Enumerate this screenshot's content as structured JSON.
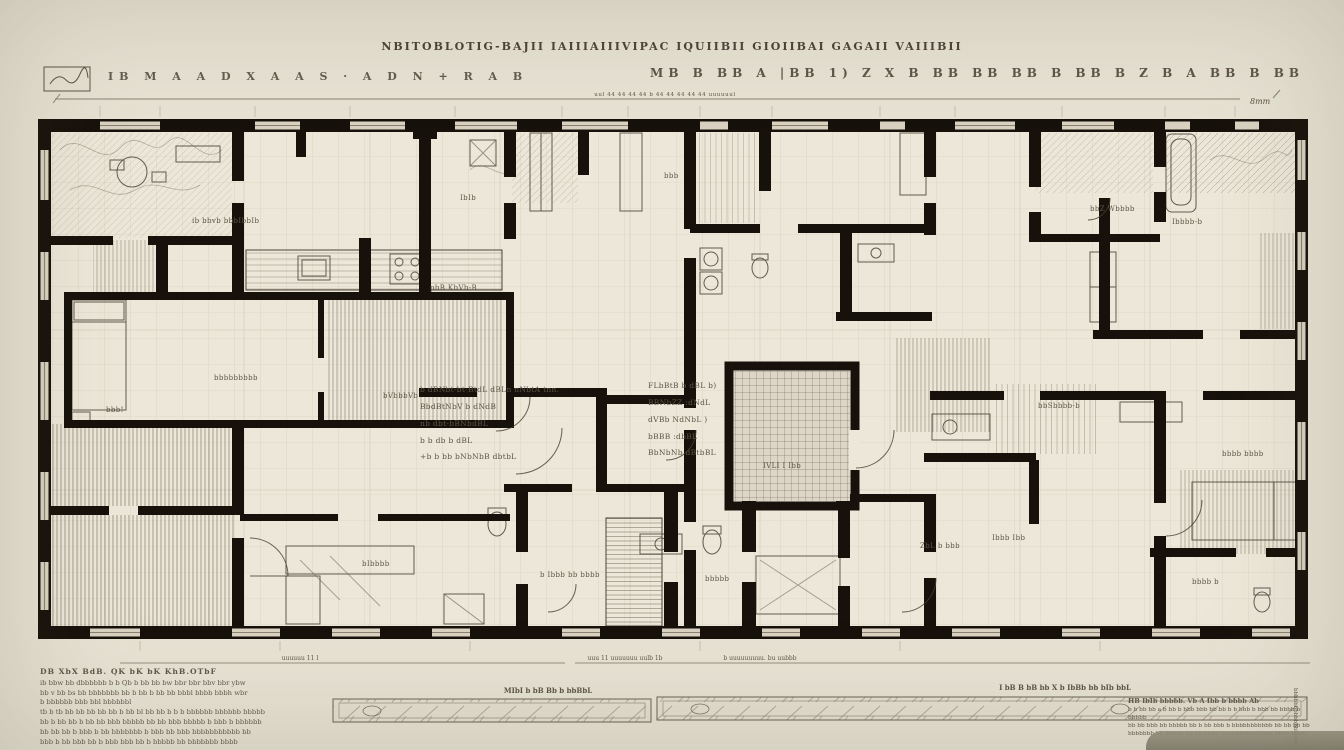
{
  "colors": {
    "paper": "#e7e2d3",
    "plan_paper": "#ece7d8",
    "ink": "#17110b",
    "rule": "#8a8172",
    "text_ink": "#5f5648"
  },
  "header": {
    "title": "NBITOBLOTIG-BAJII  IAIIIAIIIVIPAC IQUIIBII  GIOIIBAI GAGAII VAIIIBII",
    "left_marks": "IB M A A D X A A S · A D N + R A B",
    "right_marks": "MB B BB A |BB 1) Z X B BB BB BB B BB B Z B A BB B BB",
    "top_dim_text": "uul 44 44 44 44 b 44 44 44 44 44 uuuuuul",
    "scale_note": "8mm"
  },
  "plan": {
    "center_notes_left": [
      "b dBNbt-bt-BtdL dBLn nNbtA tnn.",
      "BbdBtNbV b dNdB",
      "nb dbt-bBNbdBL",
      "b b db b dBL",
      "+b b bb bNbNbB dbtbL"
    ],
    "center_notes_right": [
      "FLbBtB b dBL b)",
      "BBNbZZ :dNdL",
      "dVBb NdNbL )",
      "bBBB :dbBL",
      "BbNbNb dBtbBL"
    ],
    "labels": [
      {
        "text": "ib bbvb bbbIbbIb"
      },
      {
        "text": "IbIb"
      },
      {
        "text": "pbB KbVb-B"
      },
      {
        "text": "bbb!"
      },
      {
        "text": "bVbbbVb"
      },
      {
        "text": "bbbbbbbbb"
      },
      {
        "text": "IVLI I Ibb"
      },
      {
        "text": "bbZ Wbbbb"
      },
      {
        "text": "Ibbbb-b"
      },
      {
        "text": "b Ibbb bb bbbb"
      },
      {
        "text": "bbbbb"
      },
      {
        "text": "bIbbbb"
      },
      {
        "text": "ZbL b bbb"
      },
      {
        "text": "Ibbb Ibb"
      },
      {
        "text": "bbbb b"
      },
      {
        "text": "bbbb bbbb"
      },
      {
        "text": "bbSbbbb-b"
      },
      {
        "text": "bbb"
      }
    ]
  },
  "footer": {
    "dim_left": "uuuuuu 11 l",
    "dim_mid": "uuu 11 uuuuuuu uulb 1b",
    "dim_right": "b uuuuuuuuu. bu uubbb",
    "scalebar_a_label": "MIbI b bB Bb b bbBbL",
    "scalebar_b_label": "I bB  B  bB bb  X b IbBb bb bIb bbL",
    "notes_left_heading": "DB XbX BdB. QK bK bK KhB.OTbF",
    "notes_left_lines": [
      "ib bbw bb dbbbbbb b b Qb b bb bb bw bbr bbr bbv bbr ybw",
      "bb v bb bs bb bbbbbbb bb b bb b bb bb bbbl bbbb bbbh wbr",
      "b bbbbbb bbb bbl bbbbbbl",
      "tb b tb bb bb bb bb bb b bb bl bb bb b b b bbbbbb bbbbbb bbbbb",
      "bb b bb bb b bb bb bbb bbbbb bb bb bbb bbbbb b bbb b bbbbbb",
      "bb bb bb b bbb b bb bbbbbbb b bbb bb bbb bbbbbbbbbbb bb",
      "bbb b bb bbb bb b bbb bbb bb b bbbbb bb bbbbbbb bbbb"
    ],
    "notes_right_heading": "HB IbIb bbbbb. Vb A Ibb b bbbb Ab",
    "notes_right_lines": [
      "b b bb bb a b bb b bbb bbb bb bb b b bbb b bbb bb bbbb b bbbbb",
      "bb bb bbb bb bbbbb bb b bb bbb b bbbbbbbbbbb bb bb bb bb",
      "bbbbbbb bb bbbbb bb bb bbbb bbbbbbbbbbbbbb bbbb bbbb"
    ],
    "side_note": "bbbbbbbbbbbbbbbb"
  }
}
